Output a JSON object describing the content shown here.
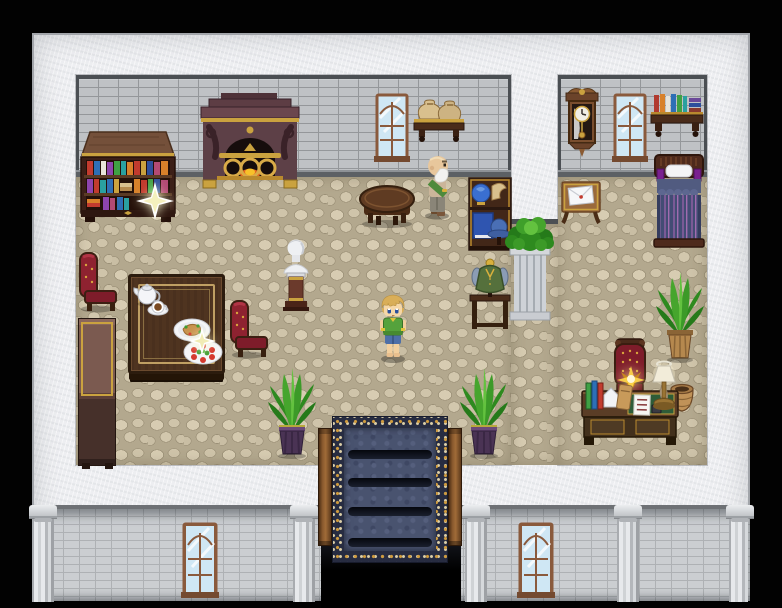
{
  "app": {
    "name": "Pixel RPG — mansion interior",
    "type": "game-screenshot",
    "visible_text": "none"
  },
  "scene": {
    "setting": "Top-down pixel-art mansion hall with study corner, dining corner and bedroom nook",
    "floor": "beige cobblestone",
    "walls": "grey brick interior, white stone exterior",
    "exit": "carpeted staircase descending at bottom center"
  },
  "characters": {
    "player": {
      "label": "Player character — blond youth in green shirt and blue shorts",
      "facing": "down"
    },
    "elder": {
      "label": "Elderly bald NPC with white beard and green sash",
      "facing": "right"
    }
  },
  "objects": {
    "fireplace": "Ornate fireplace with gilded fender",
    "bookshelf": "Bookcase with colorful volumes and sparkling item",
    "money_shelf": "Wall shelf holding two coin sacks",
    "hall_window": "Arched hall window",
    "round_table": "Small round wooden table",
    "curio_cabinet": "Curio cabinet with globe, blue book and blue hat",
    "vest_mannequin": "Mannequin stand with green vest",
    "pillar_plant": "Stone pillar topped with leafy plant",
    "marble_bust": "Marble bust on pedestal",
    "dining_table": "Dining table with tea service and meals",
    "teapot": "White teapot",
    "tea_cup": "Teacup on saucer",
    "meal_plate": "Plate with roast and greens",
    "salad_plate": "Plate of tomato salad",
    "chair_left": "Red tufted chair (facing right)",
    "chair_right": "Red tufted chair (facing left)",
    "sideboard": "Tall dark sideboard against west wall",
    "stair_plant_left": "Potted plant left of staircase",
    "stair_plant_right": "Potted plant right of staircase",
    "staircase": "Staircase descending with navy-and-gold runner",
    "grandfather_clock": "Wall-hung pendulum clock",
    "bedroom_window": "Arched bedroom window",
    "bedroom_shelf": "Wall shelf with books",
    "bed": "Single bed with striped violet quilt",
    "letter_table": "Side table with sealed envelope",
    "envelope": "White envelope with red seal",
    "desk": "Writing desk with green blotter, books, note and quill",
    "desk_note": "Handwritten note (illegible)",
    "desk_lamp": "Brass lamp with white shade",
    "basket": "Wicker basket",
    "desk_plant": "Potted plant beside desk",
    "throne_chair": "Red tufted chair with glowing golden item",
    "front_window_left": "Facade window (left)",
    "front_window_right": "Facade window (right)",
    "colonnade": "Facade column"
  },
  "highlights": {
    "bookshelf_sparkle": "Glint on bookshelf — interactable item",
    "table_sparkle": "Glint over dinner plates — interactable item",
    "chair_glow": "Glowing golden item on chair by desk — interactable item"
  },
  "palette": {
    "background": "#000000",
    "outer_wall": "#edeef1",
    "inner_brick": "#bfc2c5",
    "floor": "#cdc2a8",
    "carpet_navy": "#2b3048",
    "carpet_gold": "#cf9b3e",
    "wood_dark": "#4a2f1d",
    "upholstery_red": "#8e2230",
    "plant_green": "#46a52d",
    "accent_gold": "#c9a23f",
    "glass_blue": "#cfe7f4"
  }
}
